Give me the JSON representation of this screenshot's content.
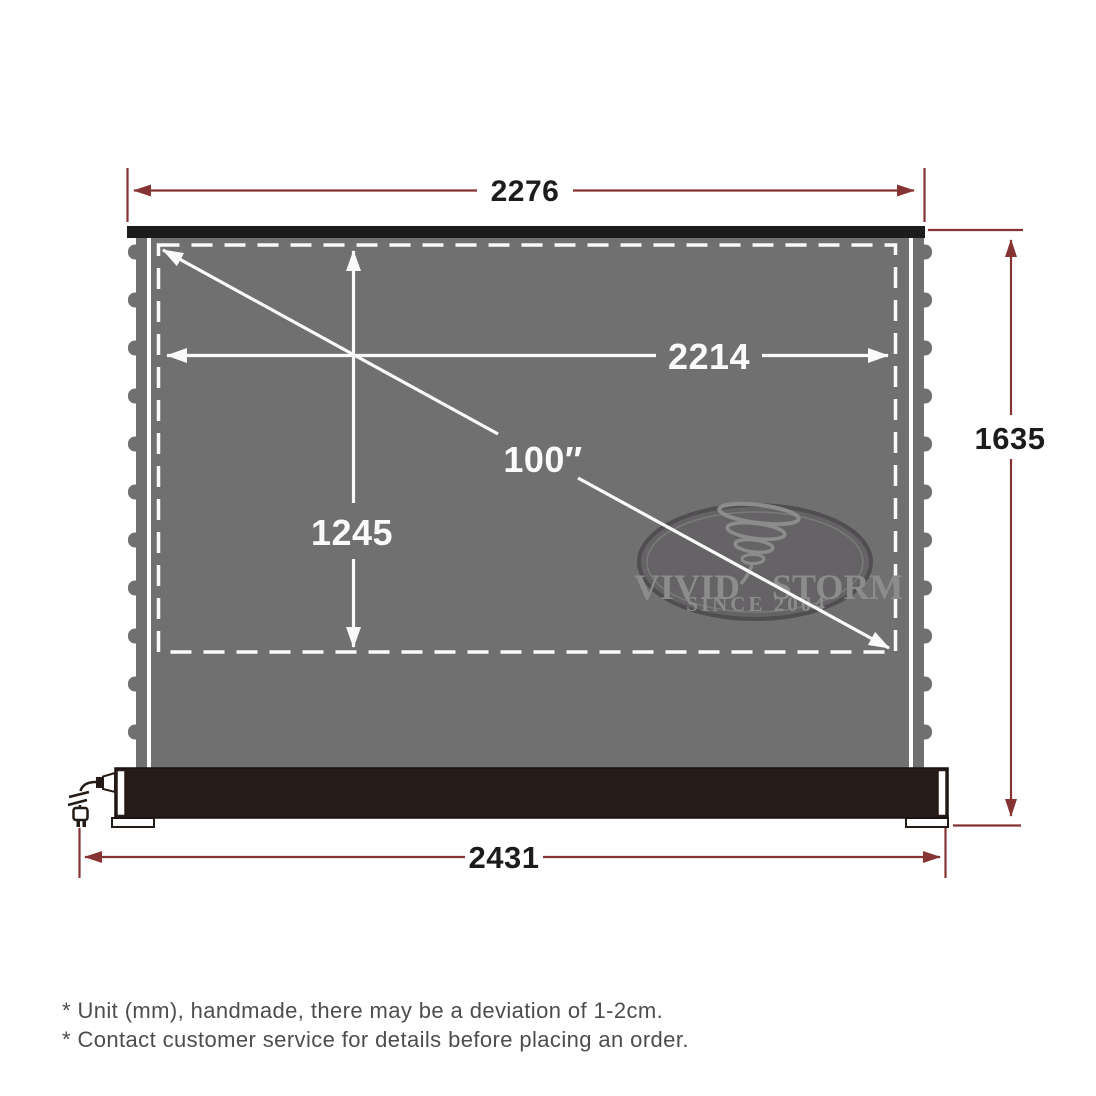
{
  "diagram": {
    "dimensions": {
      "cassette_width_mm": "2276",
      "viewing_width_mm": "2214",
      "viewing_height_mm": "1245",
      "diagonal_size": "100″",
      "overall_height_mm": "1635",
      "base_width_mm": "2431"
    },
    "watermark": {
      "brand_left": "VIVID",
      "brand_right": "STORM",
      "tagline": "SINCE 2004"
    },
    "footnotes": [
      "* Unit (mm), handmade, there may be a deviation of 1-2cm.",
      "* Contact customer service for details before placing an order."
    ],
    "colors": {
      "dimension_line": "#853333",
      "screen_surface": "#717071",
      "housing": "#261b16",
      "measurement_white": "#fafafa",
      "label_black": "#1c1c1c",
      "footnote_gray": "#4d4d4d",
      "logo_gray": "#8d8c8d"
    }
  }
}
